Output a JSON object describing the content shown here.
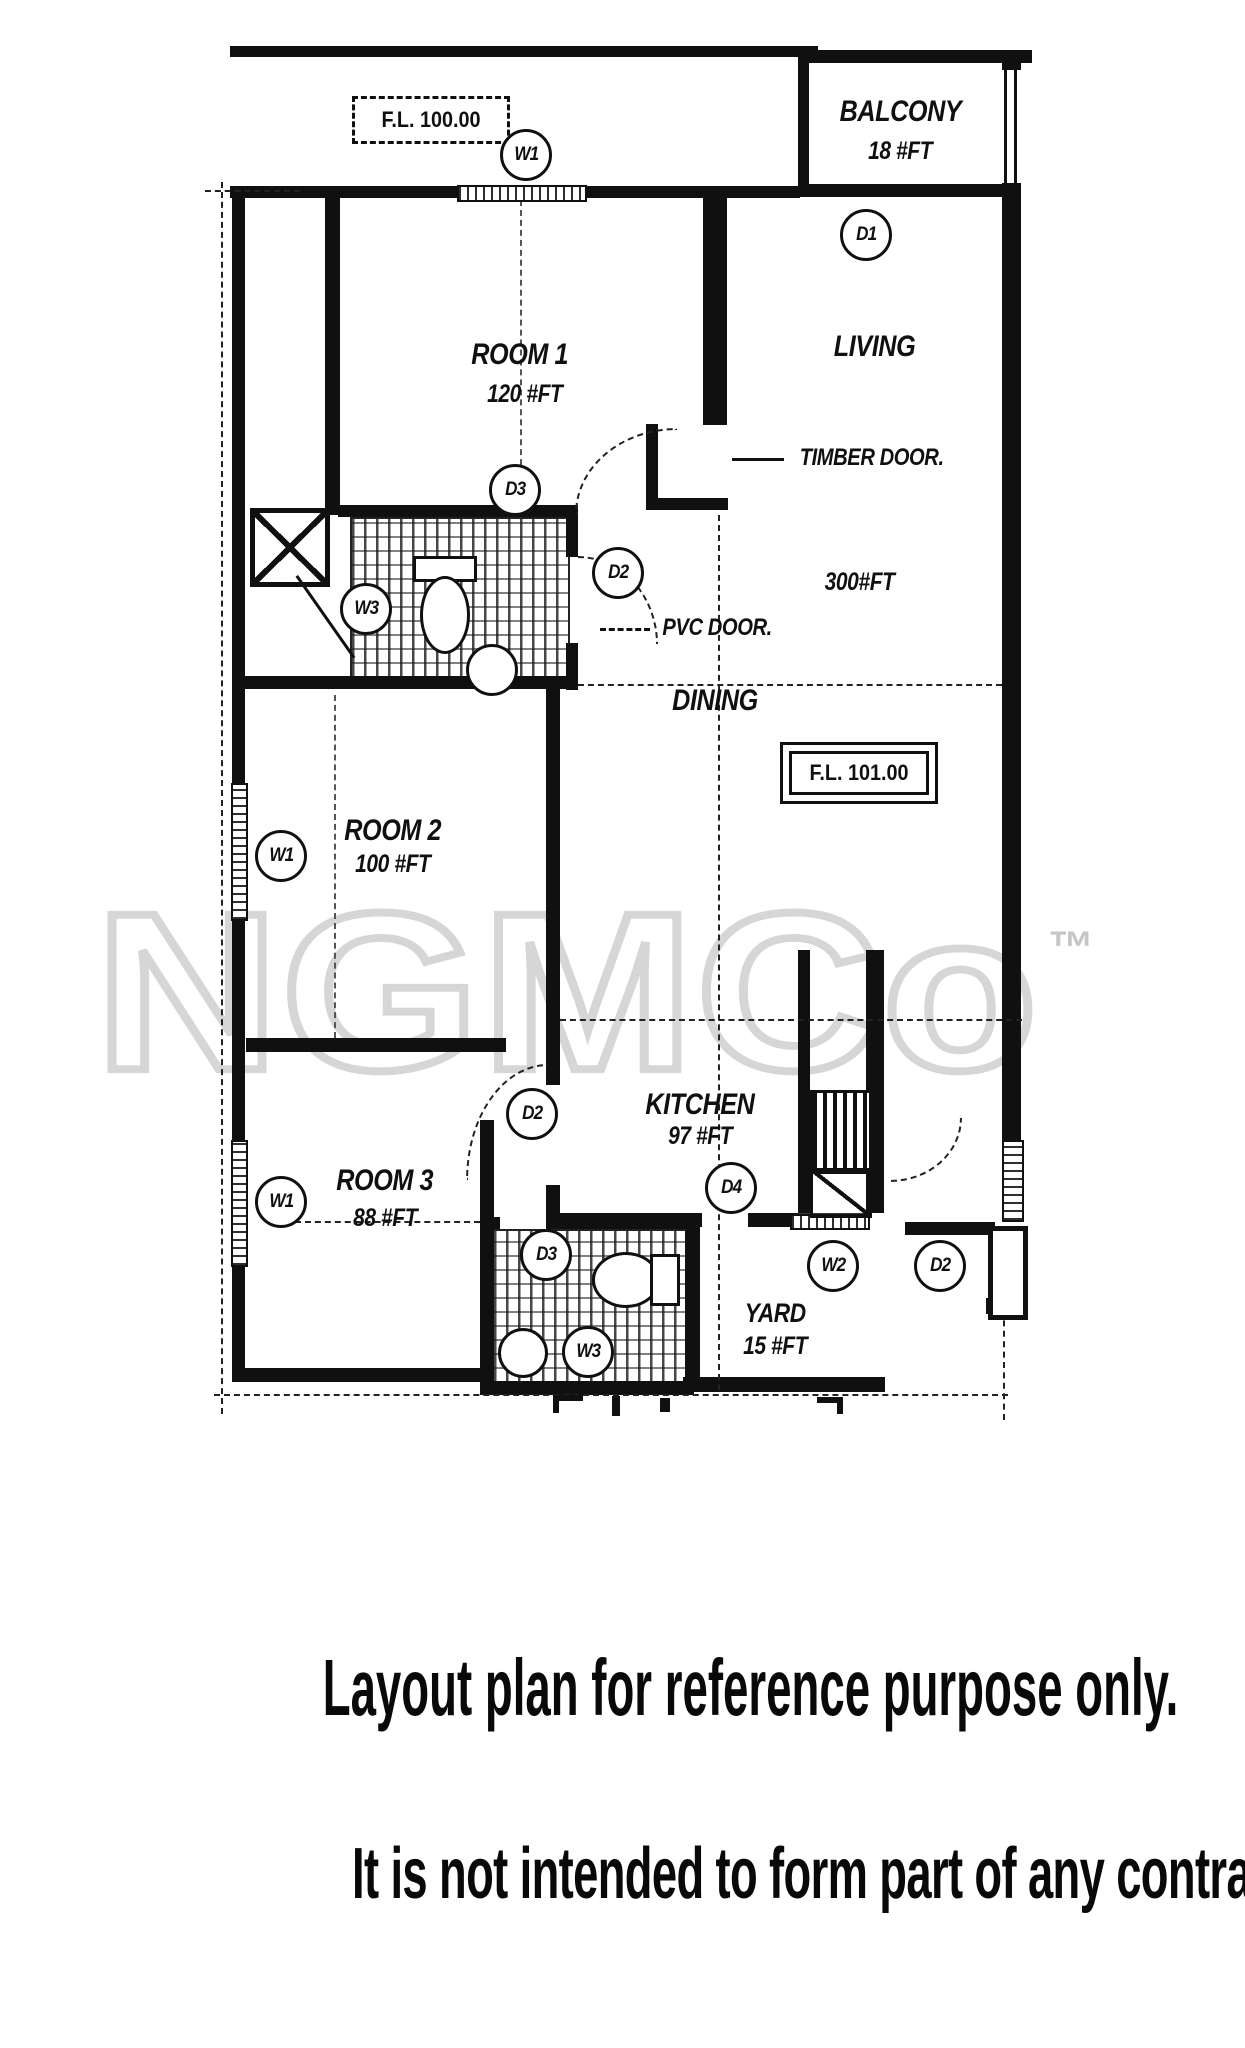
{
  "plan": {
    "floor_levels": [
      {
        "label": "F.L. 100.00"
      },
      {
        "label": "F.L. 101.00"
      }
    ],
    "rooms": [
      {
        "id": "balcony",
        "name": "BALCONY",
        "area": "18 #FT"
      },
      {
        "id": "living",
        "name": "LIVING",
        "area": "300#FT"
      },
      {
        "id": "dining",
        "name": "DINING"
      },
      {
        "id": "room1",
        "name": "ROOM 1",
        "area": "120 #FT"
      },
      {
        "id": "room2",
        "name": "ROOM 2",
        "area": "100 #FT"
      },
      {
        "id": "room3",
        "name": "ROOM 3",
        "area": "88 #FT"
      },
      {
        "id": "kitchen",
        "name": "KITCHEN",
        "area": "97 #FT"
      },
      {
        "id": "yard",
        "name": "YARD",
        "area": "15 #FT"
      }
    ],
    "door_labels": {
      "timber": "TIMBER DOOR.",
      "pvc": "PVC DOOR."
    },
    "markers": [
      {
        "label": "W1"
      },
      {
        "label": "D1"
      },
      {
        "label": "D3"
      },
      {
        "label": "D2"
      },
      {
        "label": "W3"
      },
      {
        "label": "W1"
      },
      {
        "label": "D2"
      },
      {
        "label": "W1"
      },
      {
        "label": "D3"
      },
      {
        "label": "D4"
      },
      {
        "label": "W2"
      },
      {
        "label": "D2"
      },
      {
        "label": "W3"
      }
    ]
  },
  "watermark": {
    "text": "NGMCo",
    "tm": "™"
  },
  "captions": {
    "line1": "Layout plan for reference purpose only.",
    "line2": "It is not intended to form part of any contract or warranty."
  },
  "colors": {
    "line": "#101010",
    "watermark": "#d6d6d6"
  }
}
